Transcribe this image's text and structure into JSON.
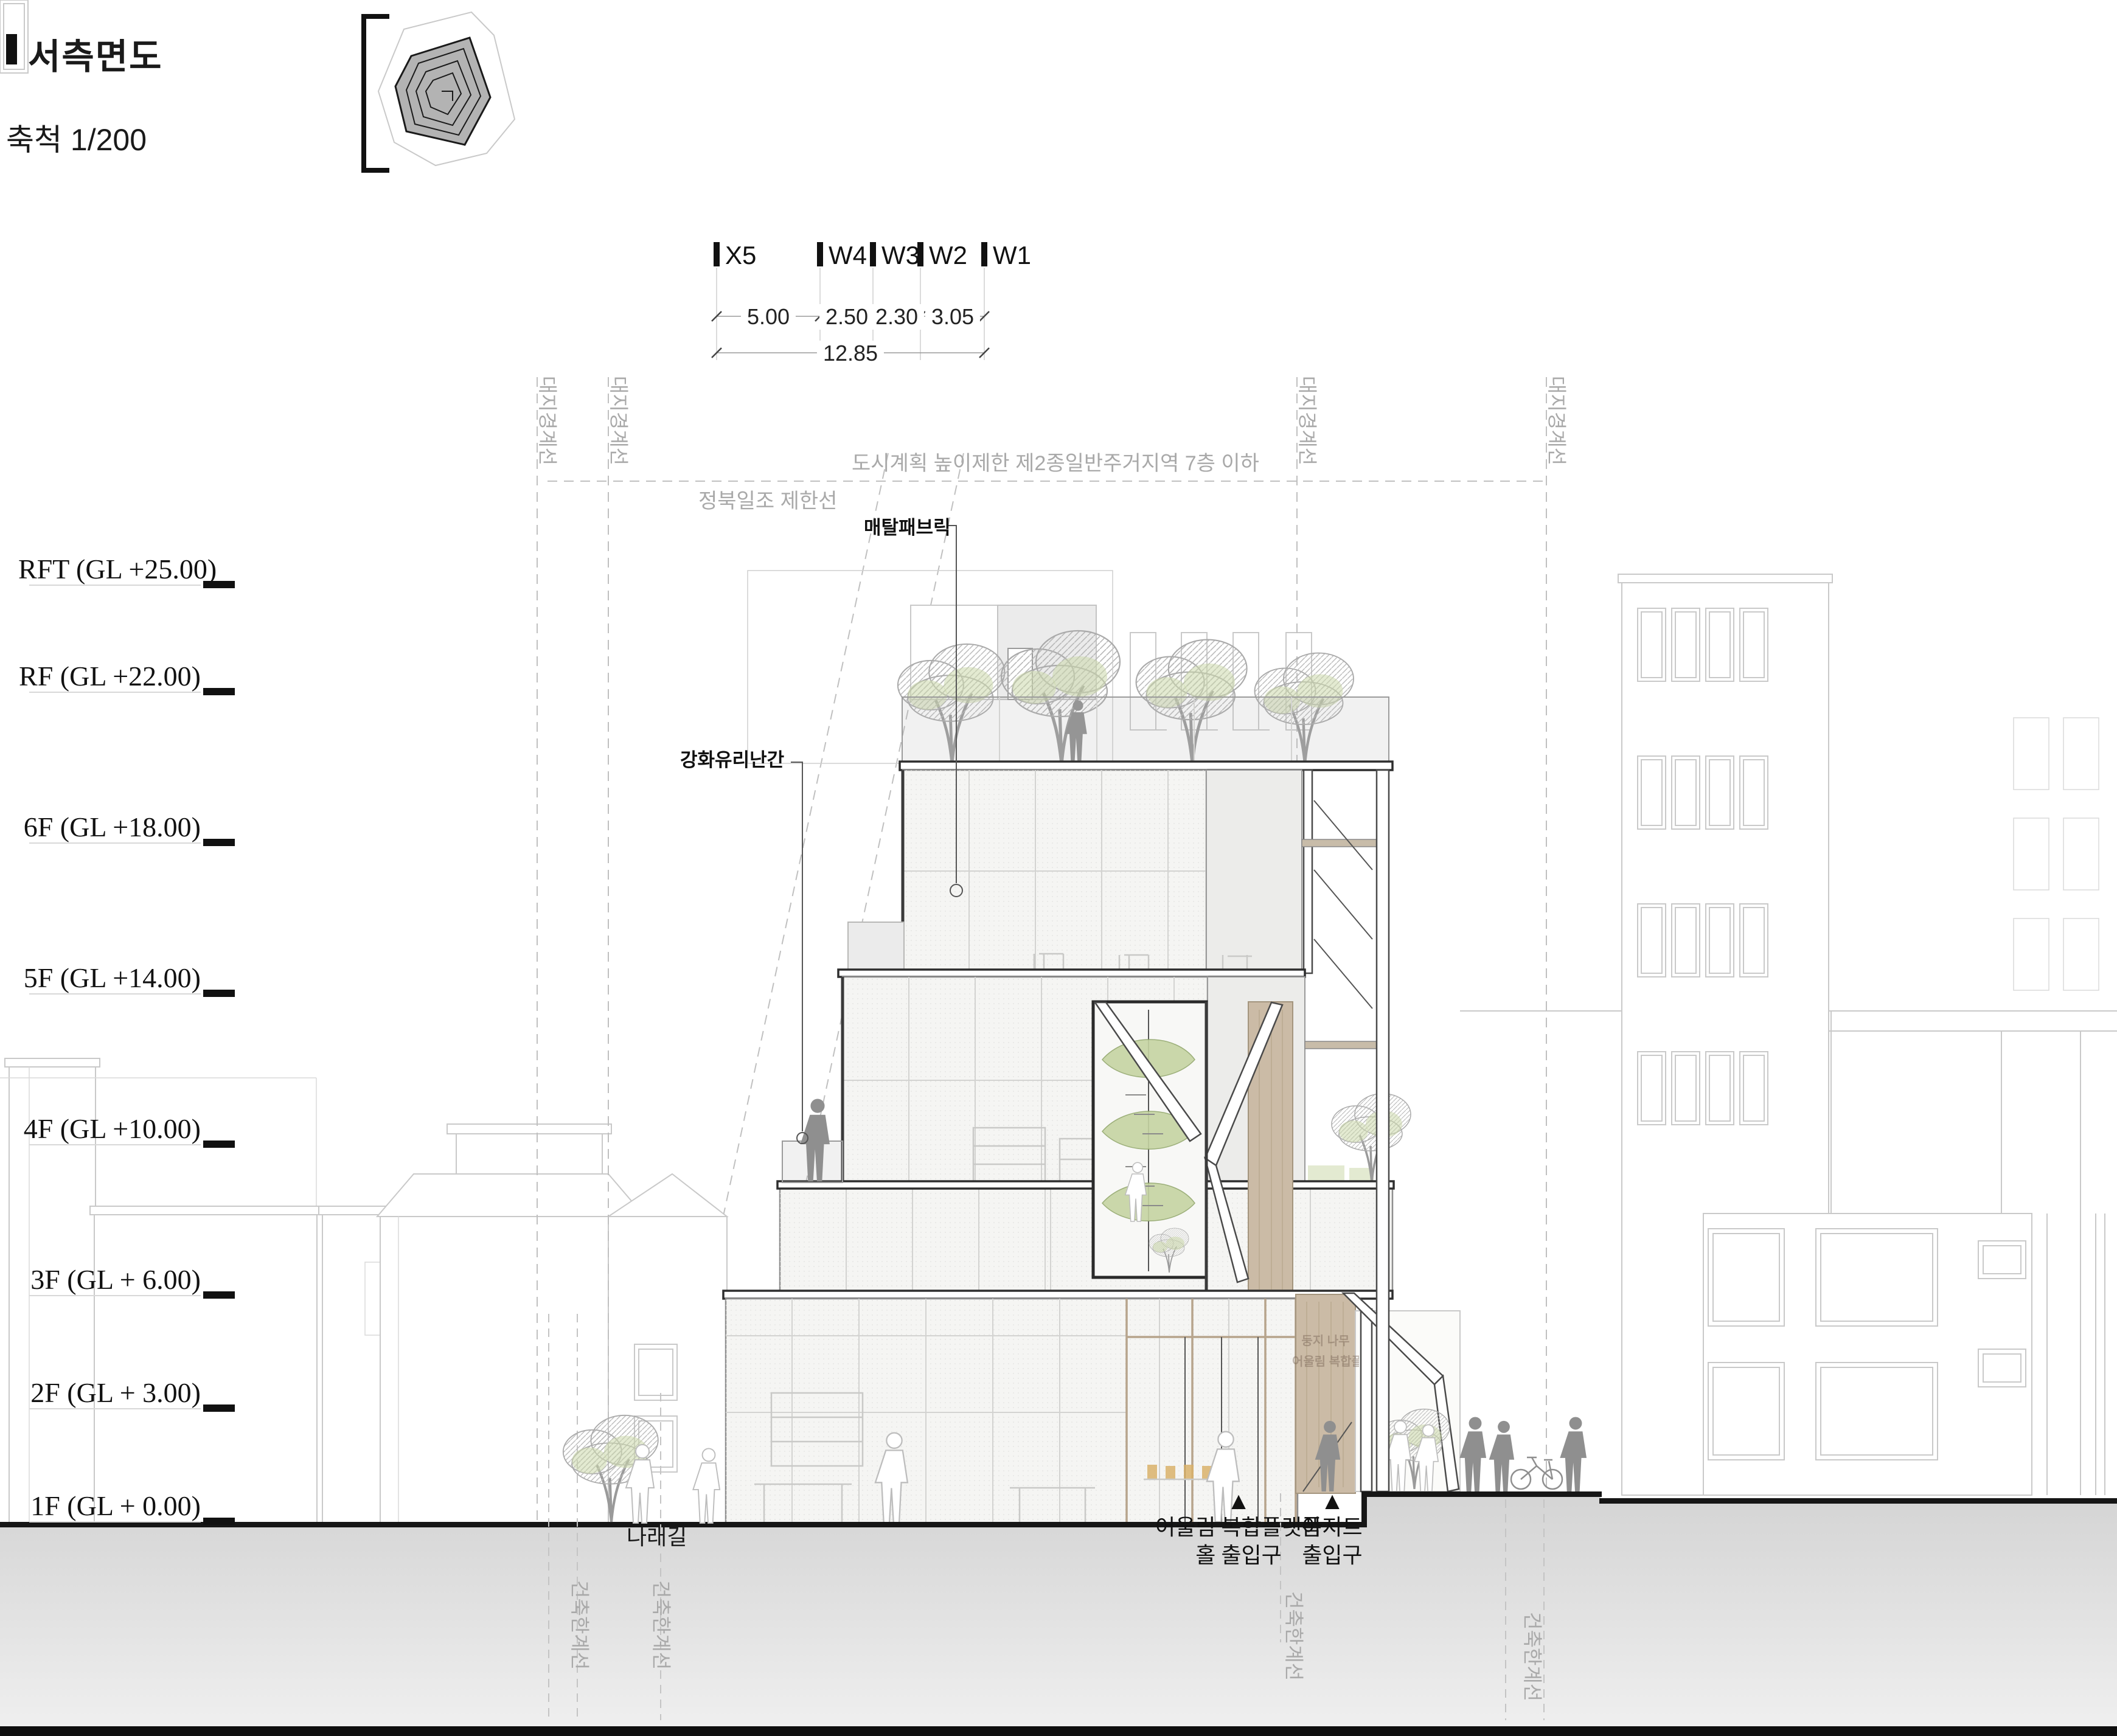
{
  "drawing": {
    "title": "서측면도",
    "scale": "축척 1/200"
  },
  "grid": {
    "columns": [
      "X5",
      "W4",
      "W3",
      "W2",
      "W1"
    ],
    "spans": [
      "5.00",
      "2.50",
      "2.30",
      "3.05"
    ],
    "total": "12.85"
  },
  "levels": [
    "RFT (GL +25.00)",
    "RF (GL +22.00)",
    "6F (GL +18.00)",
    "5F (GL +14.00)",
    "4F (GL +10.00)",
    "3F (GL + 6.00)",
    "2F (GL + 3.00)",
    "1F (GL + 0.00)"
  ],
  "annotations": {
    "site_boundary": "대지경계선",
    "height_limit": "도시계획 높이제한 제2종일반주거지역 7층 이하",
    "sun_setback": "정북일조 제한선",
    "metal_fabric": "매탈패브릭",
    "glass_railing": "강화유리난간",
    "building_limit": "건축한계선",
    "street_name": "나래길",
    "lobby_sign_line1": "둥지 나무",
    "lobby_sign_line2": "어울림 복합플랫폼"
  },
  "entrances": [
    {
      "marker": "▲",
      "line1": "어울림 복합플랫폼",
      "line2": "홀 출입구"
    },
    {
      "marker": "▲",
      "line1": "아지트",
      "line2": "출입구"
    }
  ],
  "colors": {
    "wood": "#cbbba6",
    "foliage_green": "#ccd8ab",
    "stair_green": "#c6d4a2",
    "annotation_gray": "#a9a9a9",
    "line_dark": "#2f2f2f"
  }
}
